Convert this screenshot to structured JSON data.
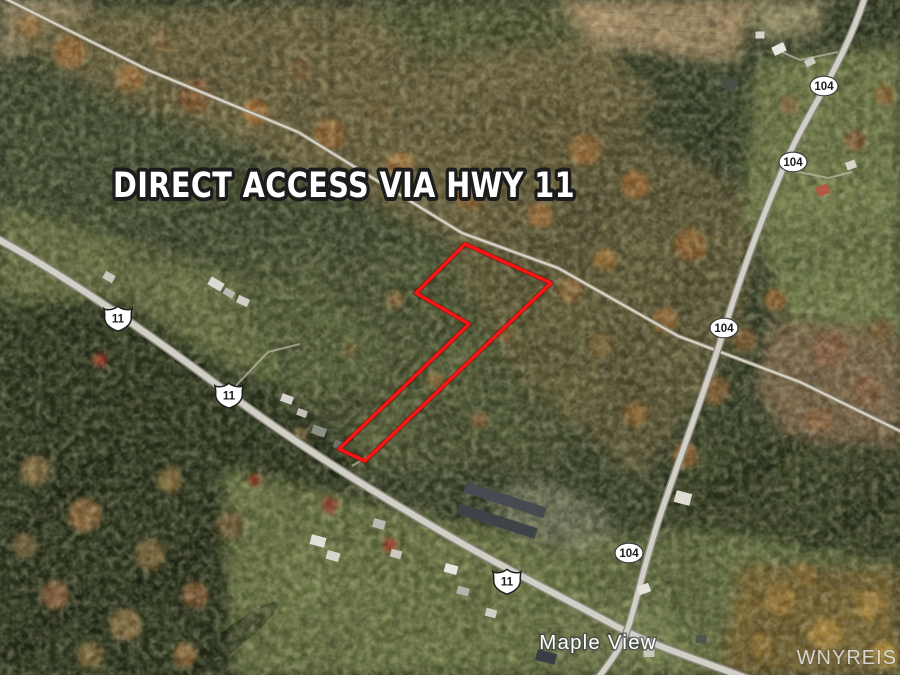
{
  "overlays": {
    "headline": "DIRECT ACCESS VIA HWY 11",
    "place_label": "Maple View",
    "watermark": "WNYREIS"
  },
  "routes": {
    "us_route_label": "11",
    "state_route_label": "104"
  },
  "colors": {
    "parcel_outline": "#ff1212",
    "headline_fill": "#ffffff",
    "headline_outline": "#1c1c1c",
    "shield_fill": "#ffffff",
    "shield_text": "#1b1b1b",
    "place_label_fill": "#ffffff"
  }
}
